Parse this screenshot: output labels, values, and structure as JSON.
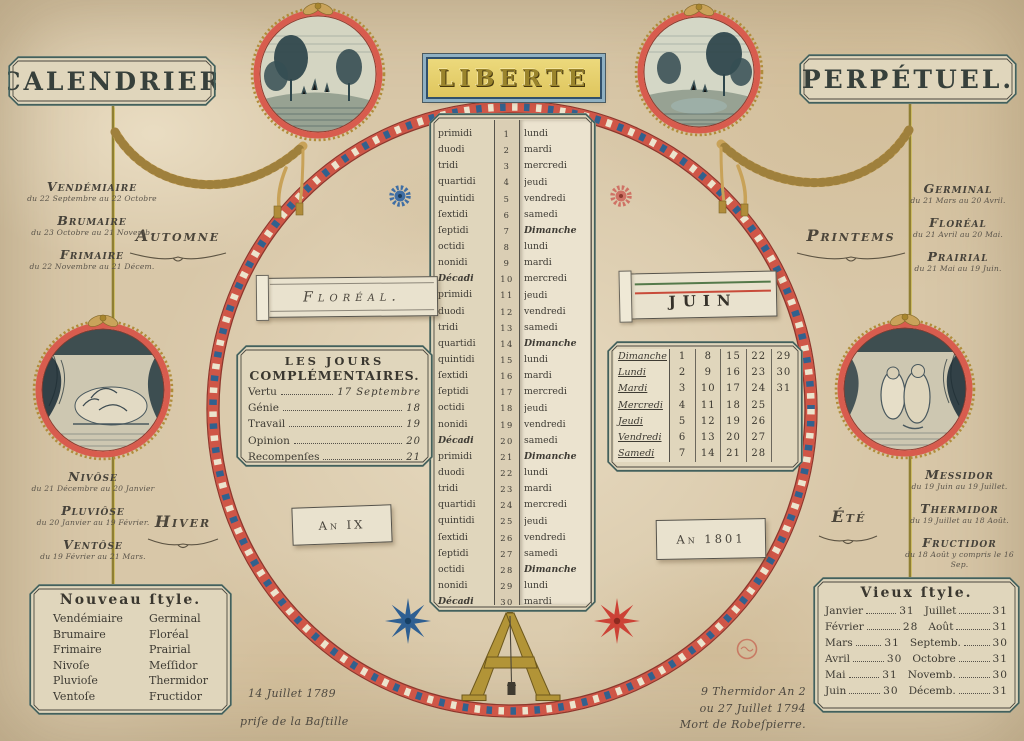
{
  "plaques": {
    "left": "CALENDRIER",
    "banner": "LIBERTE",
    "right": "PERPÉTUEL."
  },
  "seasons": {
    "automne": {
      "label": "Automne",
      "months": [
        {
          "name": "Vendémiaire",
          "range": "du 22 Septembre au 22 Octobre"
        },
        {
          "name": "Brumaire",
          "range": "du 23 Octobre au 21 Novemb."
        },
        {
          "name": "Frimaire",
          "range": "du 22 Novembre au 21 Décem."
        }
      ]
    },
    "printems": {
      "label": "Printems",
      "months": [
        {
          "name": "Germinal",
          "range": "du 21 Mars au 20 Avril."
        },
        {
          "name": "Floréal",
          "range": "du 21 Avril au 20 Mai."
        },
        {
          "name": "Prairial",
          "range": "du 21 Mai au 19 Juin."
        }
      ]
    },
    "hiver": {
      "label": "Hiver",
      "months": [
        {
          "name": "Nivôse",
          "range": "du 21 Décembre au 20 Janvier"
        },
        {
          "name": "Pluviôse",
          "range": "du 20 Janvier au 19 Février."
        },
        {
          "name": "Ventôse",
          "range": "du 19 Février au 21 Mars."
        }
      ]
    },
    "ete": {
      "label": "Été",
      "months": [
        {
          "name": "Messidor",
          "range": "du 19 Juin au 19 Juillet."
        },
        {
          "name": "Thermidor",
          "range": "du 19 Juillet au 18 Août."
        },
        {
          "name": "Fructidor",
          "range": "du 18 Août y compris le 16 Sep."
        }
      ]
    }
  },
  "windows": {
    "republican_month": "Floréal.",
    "gregorian_month": "JUIN",
    "republican_year": "An IX",
    "gregorian_year": "An 1801"
  },
  "day_strip": {
    "top_partial": "Dimanche",
    "rows": [
      {
        "r": "primidi",
        "n": "1",
        "g": "lundi"
      },
      {
        "r": "duodi",
        "n": "2",
        "g": "mardi"
      },
      {
        "r": "tridi",
        "n": "3",
        "g": "mercredi"
      },
      {
        "r": "quartidi",
        "n": "4",
        "g": "jeudi"
      },
      {
        "r": "quintidi",
        "n": "5",
        "g": "vendredi"
      },
      {
        "r": "ſextidi",
        "n": "6",
        "g": "samedi"
      },
      {
        "r": "ſeptidi",
        "n": "7",
        "g": "Dimanche"
      },
      {
        "r": "octidi",
        "n": "8",
        "g": "lundi"
      },
      {
        "r": "nonidi",
        "n": "9",
        "g": "mardi"
      },
      {
        "r": "Décadi",
        "n": "10",
        "g": "mercredi"
      },
      {
        "r": "primidi",
        "n": "11",
        "g": "jeudi"
      },
      {
        "r": "duodi",
        "n": "12",
        "g": "vendredi"
      },
      {
        "r": "tridi",
        "n": "13",
        "g": "samedi"
      },
      {
        "r": "quartidi",
        "n": "14",
        "g": "Dimanche"
      },
      {
        "r": "quintidi",
        "n": "15",
        "g": "lundi"
      },
      {
        "r": "ſextidi",
        "n": "16",
        "g": "mardi"
      },
      {
        "r": "ſeptidi",
        "n": "17",
        "g": "mercredi"
      },
      {
        "r": "octidi",
        "n": "18",
        "g": "jeudi"
      },
      {
        "r": "nonidi",
        "n": "19",
        "g": "vendredi"
      },
      {
        "r": "Décadi",
        "n": "20",
        "g": "samedi"
      },
      {
        "r": "primidi",
        "n": "21",
        "g": "Dimanche"
      },
      {
        "r": "duodi",
        "n": "22",
        "g": "lundi"
      },
      {
        "r": "tridi",
        "n": "23",
        "g": "mardi"
      },
      {
        "r": "quartidi",
        "n": "24",
        "g": "mercredi"
      },
      {
        "r": "quintidi",
        "n": "25",
        "g": "jeudi"
      },
      {
        "r": "ſextidi",
        "n": "26",
        "g": "vendredi"
      },
      {
        "r": "ſeptidi",
        "n": "27",
        "g": "samedi"
      },
      {
        "r": "octidi",
        "n": "28",
        "g": "Dimanche"
      },
      {
        "r": "nonidi",
        "n": "29",
        "g": "lundi"
      },
      {
        "r": "Décadi",
        "n": "30",
        "g": "mardi"
      }
    ]
  },
  "jours_complementaires": {
    "title_line1": "LES  JOURS",
    "title_line2": "COMPLÉMENTAIRES.",
    "entries": [
      {
        "name": "Vertu",
        "value": "17 Septembre"
      },
      {
        "name": "Génie",
        "value": "18"
      },
      {
        "name": "Travail",
        "value": "19"
      },
      {
        "name": "Opinion",
        "value": "20"
      },
      {
        "name": "Recompenſes",
        "value": "21"
      }
    ]
  },
  "weekday_grid": {
    "rows": [
      {
        "day": "Dimanche",
        "nums": [
          "1",
          "8",
          "15",
          "22",
          "29"
        ]
      },
      {
        "day": "Lundi",
        "nums": [
          "2",
          "9",
          "16",
          "23",
          "30"
        ]
      },
      {
        "day": "Mardi",
        "nums": [
          "3",
          "10",
          "17",
          "24",
          "31"
        ]
      },
      {
        "day": "Mercredi",
        "nums": [
          "4",
          "11",
          "18",
          "25",
          ""
        ]
      },
      {
        "day": "Jeudi",
        "nums": [
          "5",
          "12",
          "19",
          "26",
          ""
        ]
      },
      {
        "day": "Vendredi",
        "nums": [
          "6",
          "13",
          "20",
          "27",
          ""
        ]
      },
      {
        "day": "Samedi",
        "nums": [
          "7",
          "14",
          "21",
          "28",
          ""
        ]
      }
    ]
  },
  "nouveau_style": {
    "title": "Nouveau  ſtyle.",
    "pairs": [
      [
        "Vendémiaire",
        "Germinal"
      ],
      [
        "Brumaire",
        "Floréal"
      ],
      [
        "Frimaire",
        "Prairial"
      ],
      [
        "Nivoſe",
        "Meſſidor"
      ],
      [
        "Pluvioſe",
        "Thermidor"
      ],
      [
        "Ventoſe",
        "Fructidor"
      ]
    ]
  },
  "vieux_style": {
    "title": "Vieux  ſtyle.",
    "rows": [
      [
        "Janvier",
        "31",
        "Juillet",
        "31"
      ],
      [
        "Février",
        "28",
        "Août",
        "31"
      ],
      [
        "Mars",
        "31",
        "Septemb.",
        "30"
      ],
      [
        "Avril",
        "30",
        "Octobre",
        "31"
      ],
      [
        "Mai",
        "31",
        "Novemb.",
        "30"
      ],
      [
        "Juin",
        "30",
        "Décemb.",
        "31"
      ]
    ]
  },
  "footnotes": {
    "left": [
      "14 Juillet 1789",
      "priſe de la Baſtille"
    ],
    "right": [
      "9 Thermidor An 2",
      "ou 27 Juillet 1794",
      "Mort de Robeſpierre."
    ]
  },
  "colors": {
    "ring_red": "#cf5647",
    "bead_blue": "#31618e",
    "bead_white": "#ece4cd",
    "gold": "#b29437",
    "banner_yellow": "#ecd97c",
    "frame_teal": "#43605c",
    "ink": "#42403a"
  }
}
